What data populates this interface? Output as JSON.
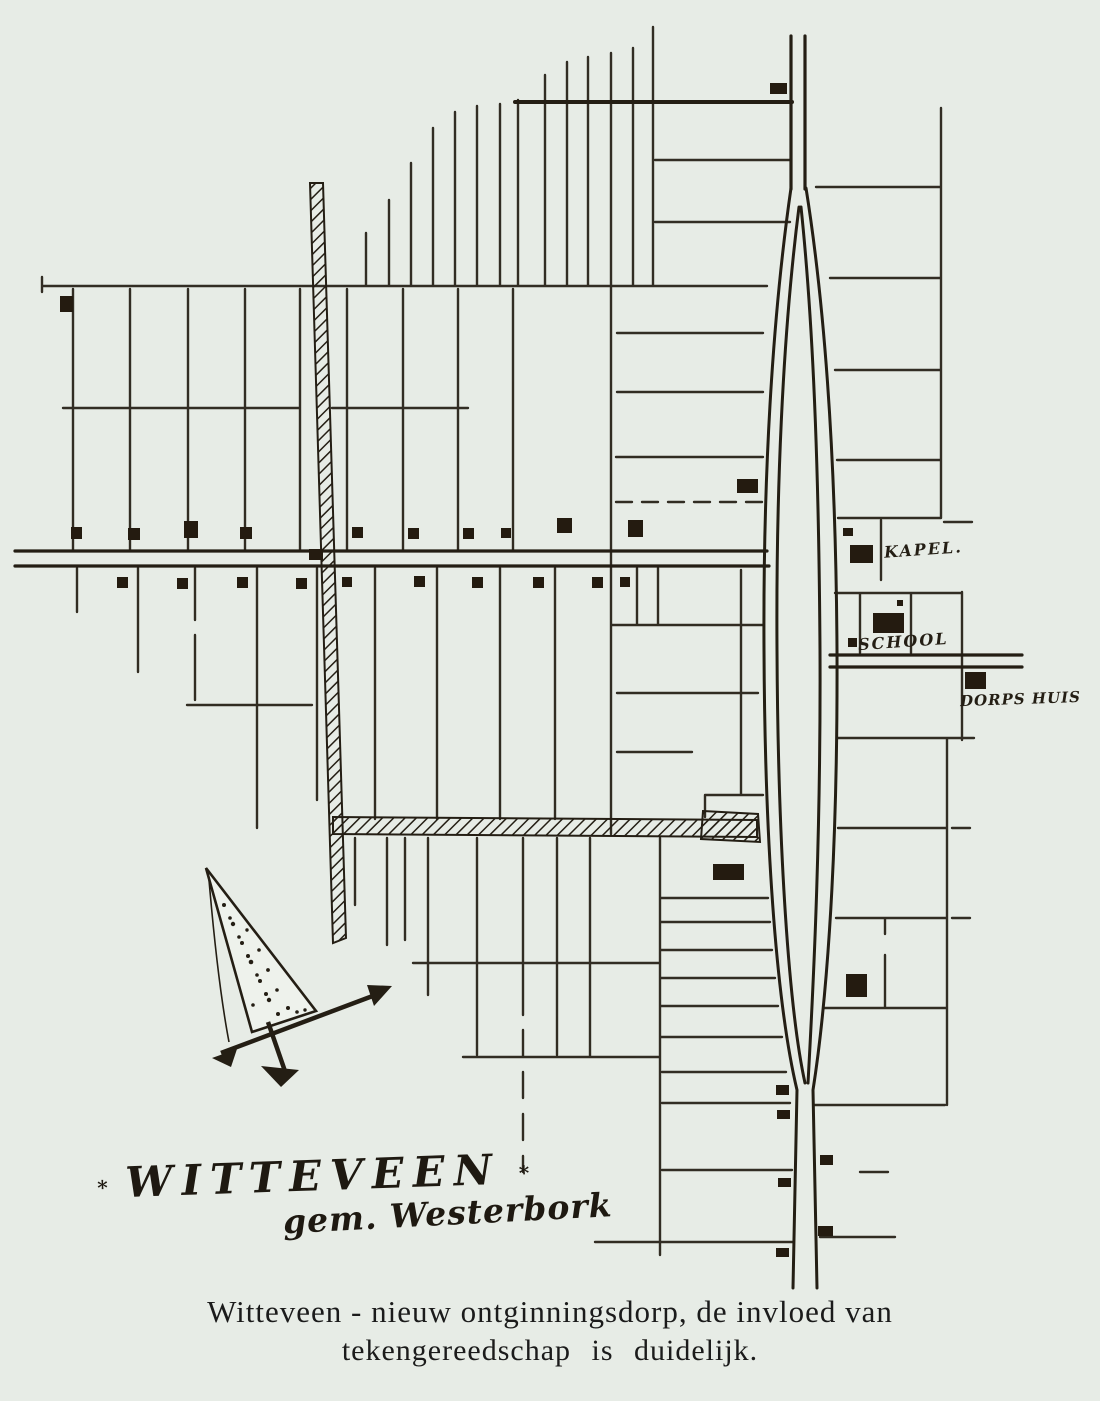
{
  "page": {
    "background": "#e7ece6",
    "ink": "#241e14"
  },
  "map": {
    "labels": {
      "kapel": "KAPEL.",
      "school": "SCHOOL",
      "dorpshuis": "DORPS HUIS"
    },
    "title_block": {
      "mark_left": "∗",
      "title": "WITTEVEEN",
      "mark_right": "∗",
      "subtitle": "gem. Westerbork"
    },
    "caption": {
      "line1": "Witteveen - nieuw ontginningsdorp, de invloed van",
      "line2": "tekengereedschap is duidelijk."
    },
    "icons": {
      "north_arrow": "north-arrow-icon",
      "canal": "hatched-canal",
      "buildings": "building-block-marks"
    }
  }
}
